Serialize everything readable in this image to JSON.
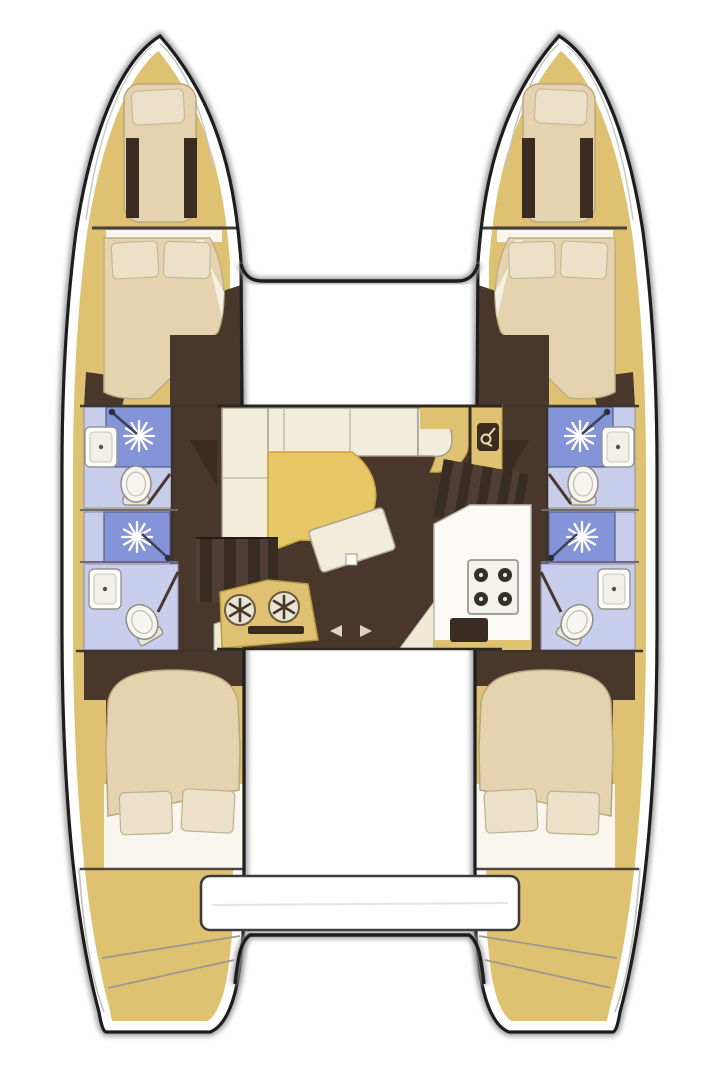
{
  "document": {
    "title": "Catamaran sailing yacht interior layout floor plan, top view",
    "type": "floor-plan"
  },
  "colors": {
    "outline": "#1d1d1d",
    "shadow": "#9a9a9a",
    "white": "#ffffff",
    "wood": "#dfc271",
    "woodlt": "#e7cf8d",
    "floor": "#4a372c",
    "dark": "#3a2c21",
    "mattress": "#e4d3ae",
    "pillow": "#ece1c8",
    "sheet": "#f8f6ef",
    "shower": "#8494d8",
    "bathfloor": "#c7cdeb",
    "cushion": "#f2ecda",
    "table": "#e7c766",
    "counter": "#fbfaf6"
  },
  "vessel": {
    "style": "catamaran, two symmetric hulls joined by center salon bridgedeck",
    "bow": {
      "features": [
        "port-forepeak-berth",
        "starboard-forepeak-berth",
        "forward-crossbeam"
      ]
    },
    "hulls": [
      {
        "side": "port",
        "cabins": [
          "forepeak-berth",
          "forward-double-cabin",
          "aft-double-cabin"
        ],
        "heads": [
          "forward-head: sink, shower, toilet",
          "aft-head: shower, sink, toilet"
        ]
      },
      {
        "side": "starboard",
        "cabins": [
          "forepeak-berth",
          "forward-double-cabin",
          "aft-double-cabin"
        ],
        "heads": [
          "forward-head: sink, shower, toilet",
          "aft-head: shower, sink, toilet"
        ]
      }
    ],
    "salon": {
      "features": [
        "l-shaped-sofa",
        "dining-table",
        "tilted-coffee-table",
        "nav-cabinet-with-faucet-icon",
        "companionway-steps-port",
        "companionway-steps-starboard",
        "galley-counter-with-4-burner-stove",
        "galley-sink-unit-twin-basins-and-oven",
        "sliding-door-marks"
      ]
    },
    "stern": {
      "features": [
        "transom-bench-platform",
        "cockpit-floor",
        "transom-steps"
      ]
    }
  }
}
